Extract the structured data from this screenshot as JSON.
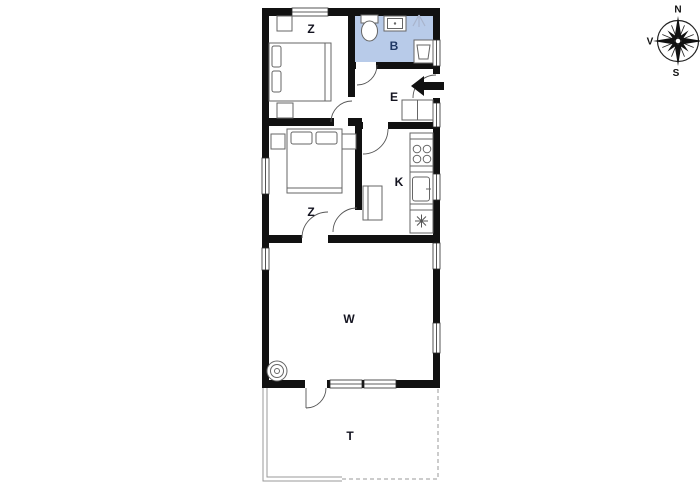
{
  "floorplan": {
    "rooms": [
      {
        "id": "bedroom-1",
        "label": "Z"
      },
      {
        "id": "bathroom",
        "label": "B"
      },
      {
        "id": "entrance",
        "label": "E"
      },
      {
        "id": "bedroom-2",
        "label": "Z"
      },
      {
        "id": "kitchen",
        "label": "K"
      },
      {
        "id": "living-room",
        "label": "W"
      },
      {
        "id": "terrace",
        "label": "T"
      }
    ],
    "colors": {
      "wall": "#111111",
      "bathroom_fill": "#b8cbe9",
      "room_label": "#141420",
      "bathroom_label": "#1f3864",
      "furniture_line": "#666666",
      "terrace_line": "#999999",
      "entry_arrow": "#111111"
    },
    "fixtures": [
      "toilet",
      "wash-basin",
      "shower",
      "washing-machine",
      "double-bed",
      "pillow",
      "wardrobe",
      "nightstand",
      "stove-top-burners",
      "kitchen-sink",
      "freezer-snowflake",
      "pantry-cupboard",
      "hall-closet",
      "wood-burning-stove",
      "entry-arrow",
      "door-swing",
      "window"
    ]
  },
  "compass": {
    "north": "N",
    "west": "V",
    "south": "S"
  }
}
